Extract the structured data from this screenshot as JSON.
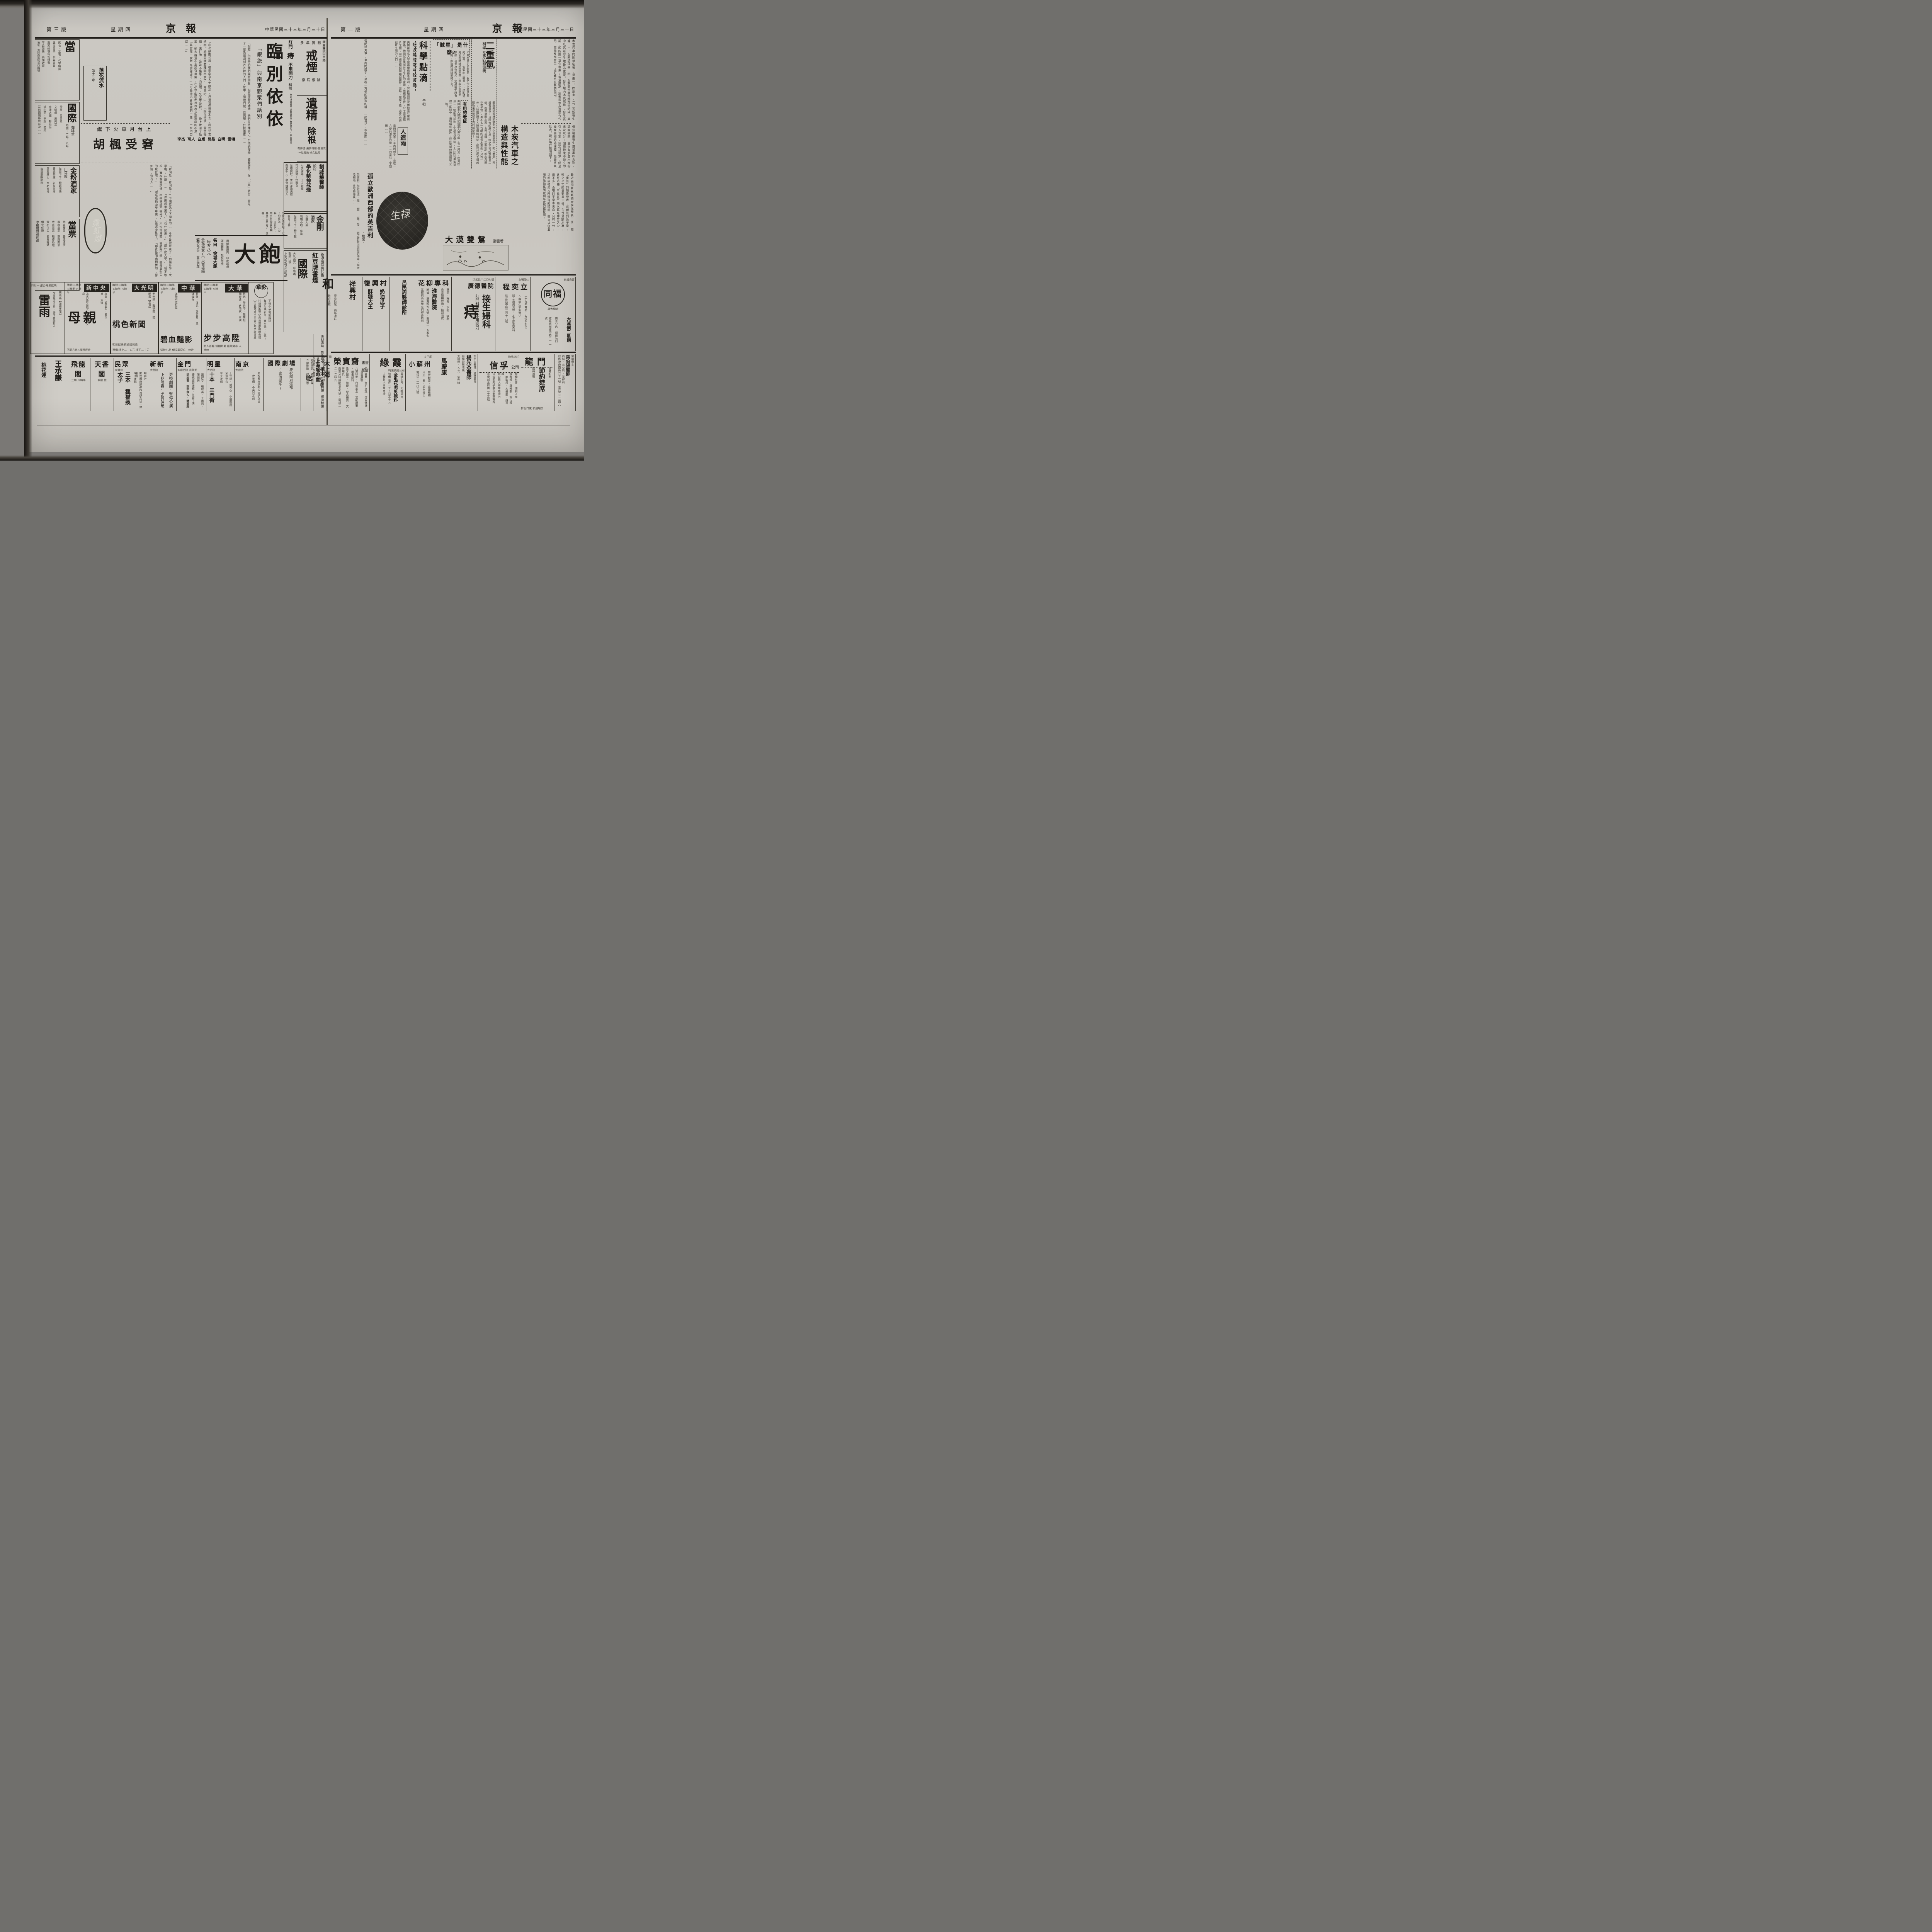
{
  "left": {
    "header": {
      "page_no": "第三版",
      "weekday": "星期四",
      "masthead": "京報",
      "date": "中華民國三十三年三月三十日"
    },
    "farewell": {
      "title": "臨別依依",
      "subtitle": "「銀旅」與南京觀眾們話別",
      "intro": "「銀旅」內來帶給我們幾許興奮;但是那麼迅速地,他們又將離去了。乍晴的夜晚,披着新月,在「中喜」後台,會見了一羣為戲劇刻苦苦幹的人們,忙中,請他們說一些感想,於對南京……",
      "names": [
        "雷鳴",
        "白明",
        "呂晶",
        "白嵐",
        "可人",
        "李杰"
      ],
      "q1": "「此次敝團公演,很受南京人士歡迎,真使我們過意不去,我們非常感謝。過幾天就要離開南京了,再見吧!」",
      "q2": "「腐化得很,爸爸抽烟,媽打牌,妹妹不懂事,而我呢,又太不能幹。」",
      "q3": "「其實那一家不是這樣呢?」「可是總不會像我們一樣,一家四口都……」",
      "q4": "晚上被灌了點酒,她大概還不至於有勇氣,在小徐面前赤裸裸表示對家庭的不滿。",
      "q5": "「你應該畢業了。」「有什麼用?」「讀什麼大學。」「我不敢想,實在像我這樣,中學已經不容易了,不怕你見笑,我的升中學,還是靠別人的幫忙呢!」",
      "q6": "「環境能夠中學畢業,已經不容易了。」「那真是同病相憐的,譬如我,沒有人……」"
    },
    "hufeng": {
      "kicker": "纔下火車月台上",
      "title": "胡楓受窘",
      "body": "「看明是,看明是!」下關車站上下閘車的……今年暑假畢業了,預備升學,大學嗎?什麼……"
    },
    "serial": {
      "title": "落花流水",
      "chapter": "第十三章"
    },
    "neon": {
      "script": "霓虹燈"
    },
    "filler1": "怎麼的情形吧,以下的事怎……尖兵……朋友們,南京是後會有期,甚麼天點去了,還甚……",
    "rail_left": {
      "pawn1": {
        "big": "當",
        "l1": "舊衣·當表·代客購當",
        "l2": "專收當票·代客賣買",
        "l3": "專家修理各式鐘表",
        "l4": "不論新舊·高價收買",
        "addr": "地址:貢院西街靴巷口四號"
      },
      "guoji": {
        "name": "國際",
        "sub": "咖啡室",
        "times": "時間:二時·八時",
        "l1": "滑稽 馬壽延",
        "l2": "文明戲 謝芮芝",
        "l3": "京津大鼓 聯幼茹",
        "l4": "姚少英·皇后·美英",
        "l5": "琵琶四胡絲絃以及……"
      },
      "jinfen": {
        "name": "金粉酒家",
        "sub": "川菜館",
        "l1": "每日下午二時起增設",
        "l2": "音樂茶座·新型茶座",
        "l3": "廣東點心·西點咖啡",
        "l4": "每日更換節目"
      },
      "pawn2": {
        "name": "當票",
        "l1": "代客贖當·路遠通信",
        "l2": "專收當票·到府面洽",
        "l3": "代客買賣·精修各種",
        "l4": "鑽石洋金·名貴鐘錶",
        "l5": "佣金低廉",
        "shop": "李維鐘錶修理處"
      }
    },
    "rail_right": {
      "quit": {
        "clinic": "廣東醫院中華路",
        "kicker": "多年實驗",
        "big": "戒煙",
        "sub": "徹底根除"
      },
      "sperm": {
        "big": "遺精",
        "sub": "除根",
        "notes": "有夢遺·無夢滑精·色淺流·一貼見效·永久貼除"
      },
      "piles": {
        "l1": "肛門",
        "big": "痔",
        "l2": "不用開刀",
        "l3": "科病",
        "addr": "京衛府路西口遠東藥房下首設診所·中央商場"
      },
      "liu": {
        "name": "劉威華醫師",
        "sub": "設科",
        "slogan": "學化精神戒煙",
        "d1": "七天滿毒·十天斷癮",
        "d2": "可以照常工作進食",
        "d3": "每夜安眠·並可兼治病症",
        "d4": "費五千元·宿食雜費每人"
      },
      "jingang": {
        "name": "金剛",
        "sub": "酒家",
        "l1": "京蘇大菜",
        "l2": "石瑛小唱·伴奏",
        "l3": "每日下午二時半起",
        "l4": "歌唱比賽"
      },
      "redbean": {
        "l1": "各酒店均有代售",
        "brand": "紅豆牌香煙",
        "name": "國際",
        "l2": "大乳白式·彩色嘴",
        "l3": "歡迎比較",
        "maker": "上海新烟公司出品"
      },
      "coffin": {
        "l1": "壽材壽坊",
        "l2": "貨色齊全",
        "l3": "棺木",
        "l4": "售價特廉",
        "l5": "經濟特廉"
      }
    },
    "dabao": {
      "big": "大飽",
      "l1": "用鮮嫩雞肉·印度喀喱",
      "l2": "頭號麵粉·配製而成",
      "name": "名曰 金城大飽",
      "price": "每客八元",
      "shop": "金城酒家(中央商場隔壁)",
      "hours": "點心部份·全日供應"
    },
    "cinemas": [
      {
        "name": "華影",
        "l1": "下列中華電影四院",
        "l2": "每場加映新聞(第七號·六號)",
        "l3": "㈠總理逝世紀念日首都植樹典禮",
        "l4": "㈡決戰時期中日青少年勇猛訓練"
      },
      {
        "name": "大華",
        "times": "時間:二時半·五時半·八時半",
        "stars": "張帆·殷秀岑·韓蘭根·關宏達·倉隱秋 主演",
        "film": "步步高陞",
        "tag": "窮人百雜·鴿棚拜弟·瘋院笑非·人皆啼"
      },
      {
        "name": "中華",
        "times": "時間:二時半·五時半·八時半",
        "stars": "張靜·浦克·張奕聰 主演傑作",
        "kicker": "滿映四大紅星",
        "film": "碧血豔影",
        "tag": "滿映出品·偵探離奇唯一佳片"
      },
      {
        "name": "大光明",
        "times": "時間:二時半·五時半·八時半",
        "stars": "尤光照·龔秋霞·陸明露【主演】",
        "film": "桃色新聞",
        "next": "明日獻映:費貞娥刺虎",
        "price": "票價:樓上二十五元·樓下二十元"
      },
      {
        "name": "新中央",
        "times": "時間:二時半·五時半·八時半",
        "stars": "梅熹·顧蘭君·呂玉堃 主演",
        "kicker": "為求家庭幸福◇創立學校父母",
        "film": "母親",
        "tag": "不同凡俗◇倫理巨片"
      },
      {
        "name": "國民",
        "kicker": "四月一日起·電影獻映",
        "stars": "陳燕燕【領銜主演】",
        "film": "雷雨",
        "tag": "故事離奇曲折·感情哀豔動人"
      }
    ],
    "theaters": [
      {
        "name": "上海咖啡室",
        "k": "如欲更換口味請到",
        "l1": "名師烹調·標準西菜",
        "l2": "芥厘雞飯·經濟實惠",
        "big": "吃",
        "loc": "大華戲院對面"
      },
      {
        "name": "國際劇場",
        "l1": "慶祝國府還都",
        "l2": "(票價減半)"
      },
      {
        "name": "南京",
        "sub": "大戲院",
        "l1": "慶祝國府還都四週紀念日",
        "l2": "一律半價·今天日夜戲"
      },
      {
        "name": "明星",
        "sub": "大戲院",
        "stars": "王少樓·劉琴心·小劉鳳霞 全班登台",
        "l1": "今天夜戲",
        "film": "十本 三門街"
      },
      {
        "name": "金門",
        "sub": "茶廳戲院·貢院街",
        "stars": "蕭迎春·張蝶英·王鳳岩·張麗葵",
        "l1": "慶祝國府還都·茶資半價",
        "film": "捉放曹·空中飛人·鰻首庵"
      },
      {
        "name": "新新",
        "sub": "大戲院",
        "l1": "更換劇團·暫停公演",
        "l2": "下期陣容·尤其彈硬"
      },
      {
        "name": "民眾",
        "sub": "大舞台",
        "troupe": "鳴春社",
        "l1": "慶祝國府還都四週紀念日一律半價",
        "l2": "今天夜戲",
        "film": "三本 狸猫換太子"
      },
      {
        "name": "天香閣",
        "sub": "茶廳·戲"
      },
      {
        "name": "飛龍閣",
        "sub": "三時·八時半"
      },
      {
        "name": "王承謙",
        "sub": "桃花運"
      }
    ]
  },
  "right": {
    "header": {
      "page_no": "第二版",
      "weekday": "星期四",
      "masthead": "京報",
      "date": "中華民國三十三年三月三十日"
    },
    "charcoal": {
      "title": "木炭汽車之構造與性能",
      "p1": "木炭汽車的附帶裝置,是由一、貯炭室,二、瓦斯發生爐,三、瓦斯清淨器,四、瓦斯混合器等四部份組成,其中以瓦斯發生爐最為重要。發生爐內木炭燃燒,發生瓦斯,即所謂一氧化炭素;若溫度高,炭素與水蒸氣混合作用,還元反應發生,這可算是瓦斯的始因。",
      "p2": "但這種由發生爐發出的瓦斯,溫度極高,並含有多量木炭粉末及灰分;固體粉末不能立即引入引擎,須加以濾淨,經過幾層極細的過濾體,始能將其除去。現在略於說明如下:",
      "p3": "先須轉迴分離,遠心S形分離器,由輪入發,離……酸令以去,小遠……"
    },
    "heavyh": {
      "kicker": "科學元素的新發現",
      "title": "二重氫",
      "body": "最近美國普林斯頓大學化學系主任,把「重氫」的報告發表:這種氫的原子量,較之平常的氫要重三倍。在普通飲水裏,含有這種「三重氫」的水真是非常之少,差不多一百噸的平常水裏面,只有一分;以前居禮夫人所獲得的鐳錠,還可以從五噸的礦物裏面提到半克的鐳錠啊!"
    },
    "thief": {
      "title": "「賊星」是什麼?",
      "body": "如果在晴朗的夜裏,我們佇立於多星的天空下,仰頭向上觀望……然的遇見包圍地球的空氣層,因與空氣發生摩擦,便生出熱和光,於是我們所看見的,即是所謂賊星的光亮。"
    },
    "mouse": {
      "title": "有用的老鼠",
      "body": "美國加拿大附近亞喂那大瀑布處,有一河流,在河底通……牠拖曳前進,中途老鼠食玩,工程師利用黃鼠狼一尾線中,使牠驅逐前進,終於使電線通過該管之一端。"
    },
    "drops": {
      "box": "科學點滴",
      "byline": "子袒",
      "item": "短波無線電可殺害蟲",
      "body": "美國羅特格大學昆蟲學教授希德利,曾試驗用短波無線電以屠殺害蟲。他把試管裏面放了半打的蜜蜂,用棉花塞住,介于兩張鋁片之間,用一個電阻調節器調整好;這時,電壓下降,使其兩張鋁片之間的人們……"
    },
    "rain": {
      "title": "人造雨"
    },
    "novel": {
      "title": "大漠雙鴛",
      "author": "劉雲若"
    },
    "england": {
      "title": "孤立歐洲西部的英吉利",
      "byline": "·繼榮·",
      "body": "英吉利三部分而成,總……顛……英、愛……孤立於歐洲西部的海中,與大陸相隔一狹窄的海峽……"
    },
    "gutter": "電閃坦克車,車內的射手,坐在一方便的游泳的機……的當兒,不期而……",
    "midads": [
      {
        "k": "自織自賣",
        "name": "同福",
        "sub": "專售綢緞",
        "l1": "大減價二星期",
        "l2": "南京分店 綢緞坊口",
        "l3": "建廠杭州皮市巷二一二號"
      },
      {
        "k": "女醫學士",
        "name": "程奕立",
        "l1": "二十九年實驗·有快孕新法",
        "l2": "△專醫久不生育▽",
        "l3": "婦女痼病流帶·老手接生兒科",
        "addr": "洪武路中段一百十八號"
      },
      {
        "k": "洪武路中二〇七號",
        "name": "廣德醫院",
        "l1": "接生婦科",
        "big": "痔",
        "l2": "肛門科病·不用開刀"
      },
      {
        "k": "花柳專科",
        "name": "淮海醫院",
        "l1": "淋病·梅毒·下疳·橫痃",
        "l2": "負責短期根治·精割包皮",
        "addr": "地址:淮海路九五號·電話二一五五七",
        "note": "當都的高尚仕女們都喜歡到"
      },
      {
        "name": "呂民周醫師診所"
      },
      {
        "name": "復興村",
        "l1": "奶油瓜子",
        "l2": "酥糖大王"
      },
      {
        "name": "祥興村"
      },
      {
        "name": "和",
        "l1": "春季時髦·高等洋莊",
        "l2": "歡迎比較"
      }
    ],
    "botads": [
      {
        "k": "醫學博士",
        "name": "葉伯陽醫師",
        "l1": "內科·小兒科·花柳科",
        "l2": "特設經濟戒煙專科",
        "addr": "診所遊府西街六十一號·電話二二三四八"
      },
      {
        "name": "龍門",
        "big": "節約筵席",
        "l1": "設備新型",
        "l2": "招待週到",
        "addr": "新街口東·和劇場前"
      },
      {
        "k": "物品信託",
        "name": "信孚",
        "sub": "公司",
        "l1": "服務社會·便利人羣",
        "depts": "鐘表部·鑽戒部·古玩部·服裝部·木器部·雜件部",
        "l2": "總公司大中華商場內",
        "l3": "分公司夫子廟永安商場內",
        "l4": "貨棧部王府園二十五號"
      },
      {
        "k": "前中央醫院·鼓樓醫院",
        "name": "楊光杰醫師",
        "l1": "鼓樓診所增設",
        "l2": "太陽燈·X光·紫外線"
      },
      {
        "name": "馬慶康"
      },
      {
        "k": "夫子廟",
        "name": "小蘇州",
        "l1": "茶食糖果·喜壽糕糰",
        "l2": "只此一家·並無分出",
        "addr": "電話二二一〇八號"
      },
      {
        "name": "綠霞",
        "sub": "時裝綢緞公司",
        "l1": "最近上海·大批運到",
        "l2": "全毛花呢男袍料",
        "l3": "特價每件一千五百五十元",
        "addr": "中華路大中華商場"
      },
      {
        "name": "榮寶齋",
        "sub": "書畫紙店",
        "c1": "名人書畫·金石文玩·仿古詩牋·喜壽屏聯",
        "c2": "八寶印泥·白銅墨盒·宣紙臘箋·繪畫顏料",
        "c3": "象牙圖章·端硯·紀念冊頁·文房用具",
        "addr": "南京分店延齡巷五九號·電話二二一二四九"
      },
      {
        "k": "夫子廟",
        "name": "大上海",
        "sub": "西餐廳",
        "l1": "適合經濟需要",
        "l2": "勵行節約時菜",
        "l3": "又便宜,又實惠",
        "l4": "可稱最經濟食府"
      }
    ]
  }
}
